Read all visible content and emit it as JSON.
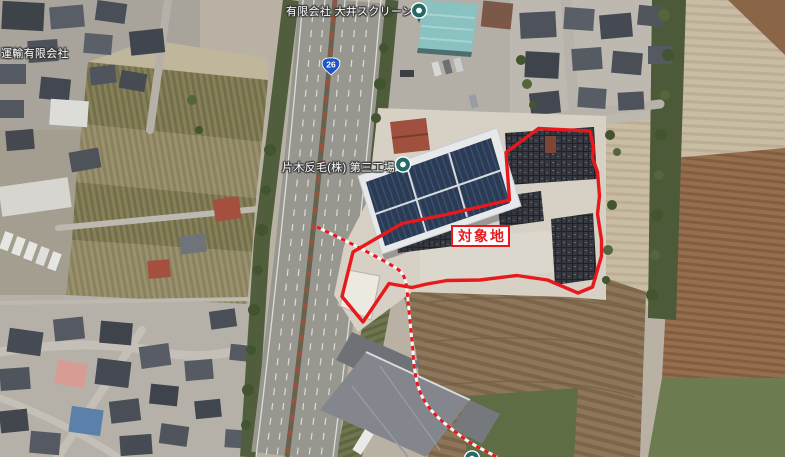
{
  "map": {
    "labels": {
      "company_top": "有限会社 大井スクリーン",
      "company_left": "片木反毛(株) 第三工場",
      "company_topleft": "運輸有限会社"
    },
    "route_shield": {
      "number": "26"
    },
    "target_site": {
      "label": "対象地"
    },
    "colors": {
      "boundary_red": "#e8191c",
      "pin_teal": "#266a67",
      "route_blue": "#1d55c8"
    },
    "boundary_path": "M538.5,128.5 L590,131 L593.5,147 L592.5,158 L597.5,172 L599.5,196 L597.5,214 L601.5,240 L601.5,256 L592.5,287 L578,293 L547.5,280 L517,275.5 L480,280 L447,280.5 L427,284 L412,287.5 L397,285 L389,283.5 L363,322 L342,296.5 L353,252 L402,223.5 L451,213.5 L509.5,200 L506,152.5 Z",
    "survey_line_path": "M317,227 C340,238 375,255 396,268 C404,273 406,280 407,290 C409,312 411,330 413,352 C414,372 417,388 424,400 C432,414 446,425 462,437 C474,446 486,451 497,457"
  }
}
